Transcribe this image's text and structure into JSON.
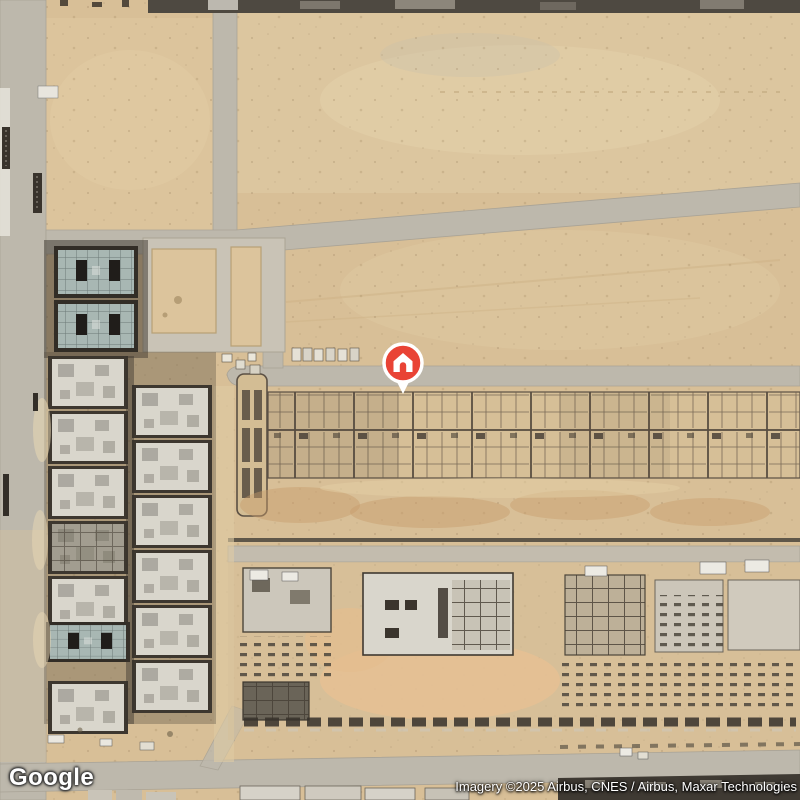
{
  "map": {
    "label": "Satellite imagery of a desert construction area with villa blocks and graded roads",
    "marker": {
      "icon": "home-pin",
      "pin_color": "#e94335",
      "outline_color": "#ffffff",
      "x": 403,
      "y": 364
    },
    "colors": {
      "sand": "#d8bf97",
      "sand_light": "#e5d2ac",
      "sand_orange": "#e0b587",
      "road": "#bdb8ac",
      "building_dark": "#3d372f",
      "building_light": "#d9d6cc",
      "roof_teal": "#a8b7b3",
      "top_strip": "#4e4941"
    }
  },
  "footer": {
    "logo": "Google",
    "attribution": "Imagery ©2025 Airbus, CNES / Airbus, Maxar Technologies"
  }
}
